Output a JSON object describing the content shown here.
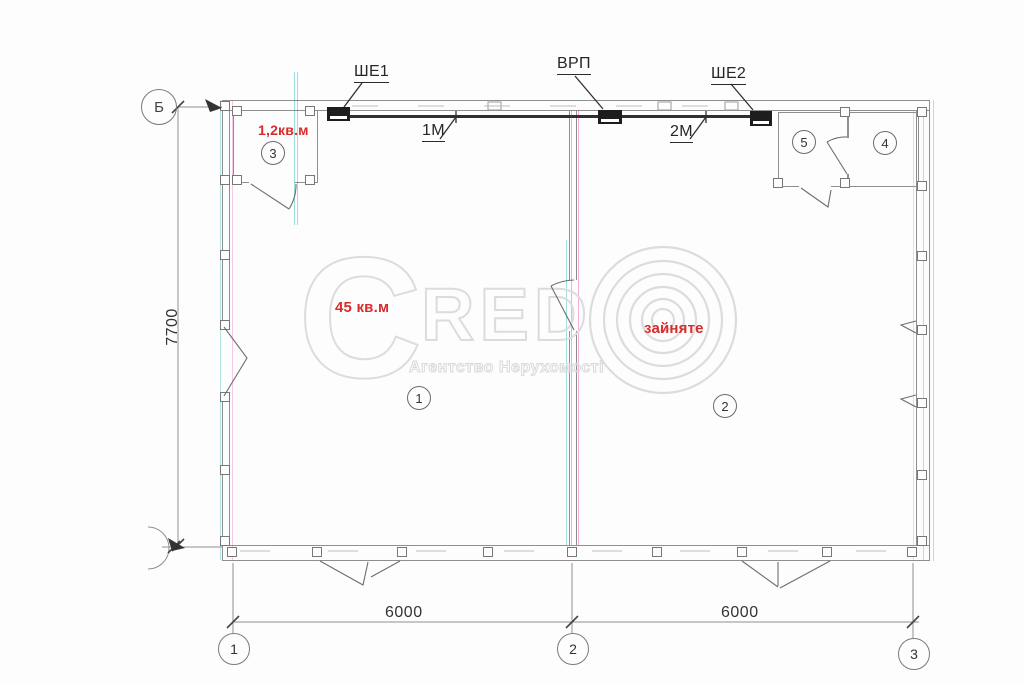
{
  "electrical": {
    "panel1_label": "ШЕ1",
    "main_panel_label": "ВРП",
    "panel2_label": "ШЕ2",
    "line1_label": "1М",
    "line2_label": "2М"
  },
  "annotations": {
    "room3_area": "1,2кв.м",
    "room1_area": "45 кв.м",
    "room2_status": "зайняте",
    "red_color": "#d92b2b"
  },
  "rooms": {
    "r1": "1",
    "r2": "2",
    "r3": "3",
    "r4": "4",
    "r5": "5"
  },
  "dimensions": {
    "left": "7700",
    "bottom_left": "6000",
    "bottom_right": "6000"
  },
  "axes": {
    "bottom": [
      "1",
      "2",
      "3"
    ],
    "left_top": "Б"
  },
  "watermark": {
    "brand_c": "C",
    "brand_rest": "RED",
    "subtitle": "Агентство Нерухомості"
  }
}
